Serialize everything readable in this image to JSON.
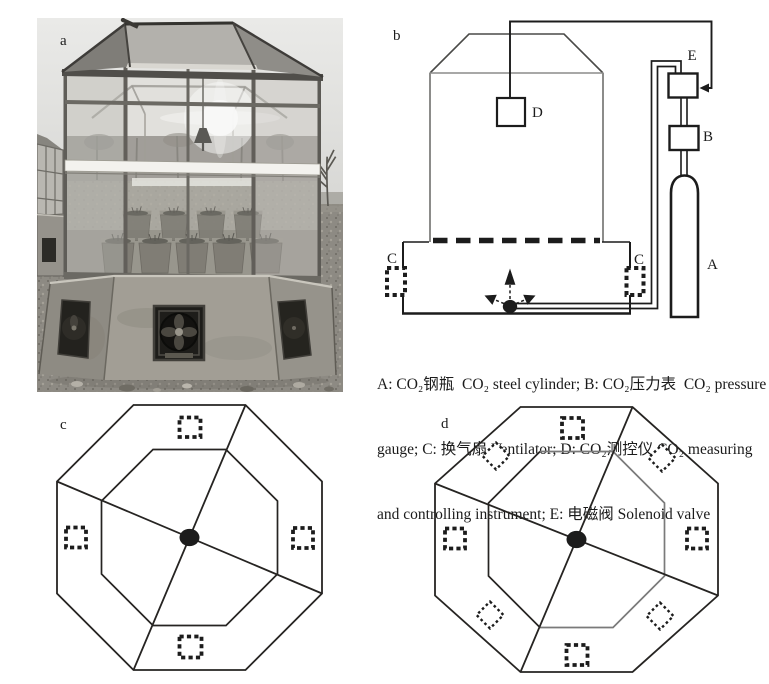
{
  "panel_a": {
    "label": "a"
  },
  "panel_b": {
    "label": "b",
    "component_labels": {
      "co2_cylinder": "A",
      "pressure_gauge": "B",
      "ventilator_left": "C",
      "ventilator_right": "C",
      "measuring_instrument": "D",
      "solenoid_valve": "E"
    }
  },
  "caption": {
    "lines": [
      "A: CO₂钢瓶  CO₂ steel cylinder; B: CO₂压力表  CO₂ pressure",
      "gauge; C: 换气扇 Ventilator; D: CO₂测控仪 CO₂ measuring",
      "and controlling instrument; E: 电磁阀 Solenoid valve"
    ]
  },
  "panel_c": {
    "label": "c"
  },
  "panel_d": {
    "label": "d"
  },
  "colors": {
    "line": "#1c1c1c",
    "wall_gray": "#8c8c8a",
    "inner_gray": "#7a7a7a",
    "page_background": "#ffffff"
  }
}
